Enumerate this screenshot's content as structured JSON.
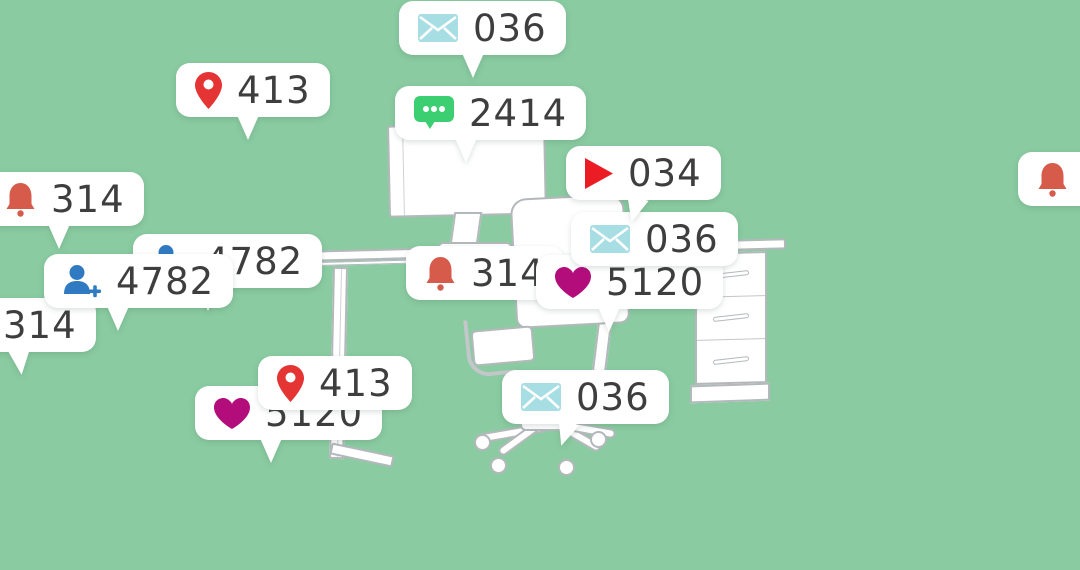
{
  "background_color": "#8acba1",
  "bubble_color": "#ffffff",
  "count_text_color": "#3e3e3e",
  "outline_color": "#b3b8bb",
  "icon_colors": {
    "mail": "#a6dee3",
    "chat": "#3bcf72",
    "pin": "#e43434",
    "play": "#ec1c24",
    "bell": "#d75b4a",
    "person": "#2f7ac0",
    "heart": "#b20d7b"
  },
  "bubbles": [
    {
      "id": "mail-top",
      "icon": "mail-icon",
      "value": "036"
    },
    {
      "id": "pin-top",
      "icon": "location-pin-icon",
      "value": "413"
    },
    {
      "id": "chat",
      "icon": "chat-icon",
      "value": "2414"
    },
    {
      "id": "play",
      "icon": "play-icon",
      "value": "034"
    },
    {
      "id": "bell-left",
      "icon": "bell-icon",
      "value": "314"
    },
    {
      "id": "person-back-left",
      "icon": "person-add-icon",
      "value": "4782"
    },
    {
      "id": "person-front-left",
      "icon": "person-add-icon",
      "value": "4782"
    },
    {
      "id": "bell-center-hidden",
      "icon": "bell-icon",
      "value": "314"
    },
    {
      "id": "mail-center",
      "icon": "mail-icon",
      "value": "036"
    },
    {
      "id": "heart-center",
      "icon": "heart-icon",
      "value": "5120"
    },
    {
      "id": "bell-far-left",
      "icon": "bell-icon",
      "value": "314"
    },
    {
      "id": "pin-bottom",
      "icon": "location-pin-icon",
      "value": "413"
    },
    {
      "id": "heart-bottom",
      "icon": "heart-icon",
      "value": "5120"
    },
    {
      "id": "mail-bottom",
      "icon": "mail-icon",
      "value": "036"
    },
    {
      "id": "bell-right-clipped",
      "icon": "bell-icon",
      "value": ""
    }
  ],
  "scene": {
    "objects": [
      "computer monitor",
      "office desk",
      "office chair",
      "drawer cabinet"
    ]
  }
}
